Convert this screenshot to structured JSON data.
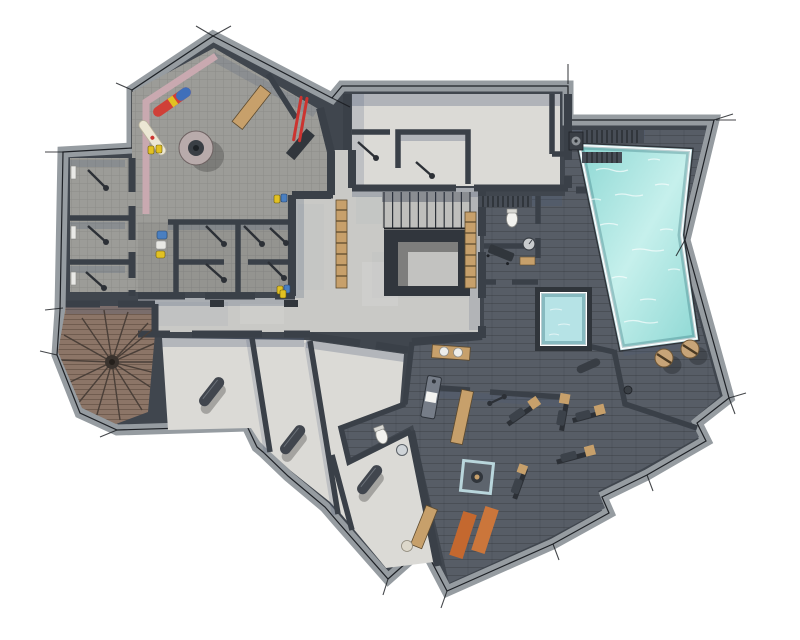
{
  "meta": {
    "title": "Basement wellness level floor plan",
    "view": "top-down rendered architectural plan",
    "width_px": 800,
    "height_px": 640
  },
  "palette": {
    "background": "#ffffff",
    "wall_fill": "#40464E",
    "wall_band": "#969CA1",
    "wall_line": "#1E2126",
    "floor_tile": "#9C9C98",
    "floor_concrete": "#C9C9C6",
    "floor_light": "#DBDAD6",
    "floor_dark_brick": "#575D66",
    "floor_wood": "#8C7567",
    "pool_water": "#8ED8D4",
    "pool_water_light": "#C6F0EC",
    "pool_rim": "#FFFFFF",
    "plunge_water": "#B6E3E6",
    "wood_accent": "#C7A06B",
    "pink_band": "#C9A9B0",
    "mat_orange_1": "#C4682F",
    "mat_orange_2": "#CB763B",
    "stool_tan": "#C7A478",
    "ski_red": "#CC3430",
    "board_red": "#D04038",
    "board_blue": "#3F6FBA",
    "board_white": "#ECE7D4",
    "boot_yellow": "#E2C122",
    "gear_blue": "#4A7FC1",
    "shadow_blue": "#4B5A77",
    "equip_dark": "#31363C"
  },
  "rooms": [
    {
      "id": "ski-room",
      "name": "Ski and boot room",
      "floor": "gray tile carpet"
    },
    {
      "id": "boot-lockers",
      "name": "Boot locker cubicles",
      "floor": "gray tile carpet"
    },
    {
      "id": "cellar-1",
      "name": "Cellar room 1",
      "floor": "gray tile"
    },
    {
      "id": "cellar-2",
      "name": "Cellar room 2",
      "floor": "gray tile"
    },
    {
      "id": "cellar-3",
      "name": "Cellar room 3",
      "floor": "gray tile"
    },
    {
      "id": "stair-hall",
      "name": "Central stair hall",
      "floor": "concrete"
    },
    {
      "id": "corridor",
      "name": "Corridor",
      "floor": "concrete"
    },
    {
      "id": "technical-room-1",
      "name": "Technical room west",
      "floor": "screed"
    },
    {
      "id": "technical-room-2",
      "name": "Technical room east",
      "floor": "screed"
    },
    {
      "id": "sauna",
      "name": "Sauna",
      "floor": "dark brick tile"
    },
    {
      "id": "spa-shower-wc",
      "name": "Spa shower and WC",
      "floor": "dark brick tile"
    },
    {
      "id": "spa-lounge",
      "name": "Spa relaxation area",
      "floor": "dark brick tile"
    },
    {
      "id": "pool-hall",
      "name": "Pool deck",
      "floor": "dark brick tile"
    },
    {
      "id": "massage-room",
      "name": "Massage room",
      "floor": "dark brick tile"
    },
    {
      "id": "wc",
      "name": "WC",
      "floor": "dark brick tile"
    },
    {
      "id": "gym",
      "name": "Fitness room",
      "floor": "dark brick tile"
    },
    {
      "id": "storage-1",
      "name": "Storage room 1",
      "floor": "light screed"
    },
    {
      "id": "storage-2",
      "name": "Storage room 2",
      "floor": "light screed"
    },
    {
      "id": "storage-3",
      "name": "Storage room 3",
      "floor": "light screed"
    },
    {
      "id": "spiral-stair-room",
      "name": "Spiral stair room",
      "floor": "wood plank"
    }
  ],
  "water_features": [
    {
      "id": "swimming-pool",
      "name": "Swimming pool",
      "shape": "irregular quadrilateral"
    },
    {
      "id": "plunge-pool",
      "name": "Plunge pool",
      "shape": "square"
    }
  ],
  "stairs": [
    {
      "id": "main-stair",
      "name": "Main staircase with open well",
      "treads_visible": 11
    },
    {
      "id": "spiral-stair",
      "name": "Wooden spiral staircase",
      "treads_visible": 16
    }
  ],
  "equipment": {
    "ski_room": [
      "circular boot dryer",
      "wooden bench",
      "red-blue snowboard",
      "white snowboard",
      "pair of red skis",
      "yellow ski boots",
      "blue gear bags"
    ],
    "sauna": [
      "slatted benches",
      "sauna heater"
    ],
    "spa": [
      "slatted bench",
      "toilet",
      "round gauge",
      "wooden foot mat",
      "lounger"
    ],
    "massage_room": [
      "massage table with towel",
      "vanity counter with two basins"
    ],
    "wc": [
      "toilet",
      "round basin"
    ],
    "gym": [
      "weight bench machines x5",
      "barbell",
      "glass enclosure",
      "wooden wall benches",
      "exercise ball",
      "orange yoga mats x2"
    ],
    "pool_deck": [
      "round tan stools x2",
      "foam roller",
      "floor drain"
    ],
    "storage_rooms": [
      "dark storage cylinders x3"
    ],
    "hall": [
      "wooden wall ladders x2"
    ]
  }
}
